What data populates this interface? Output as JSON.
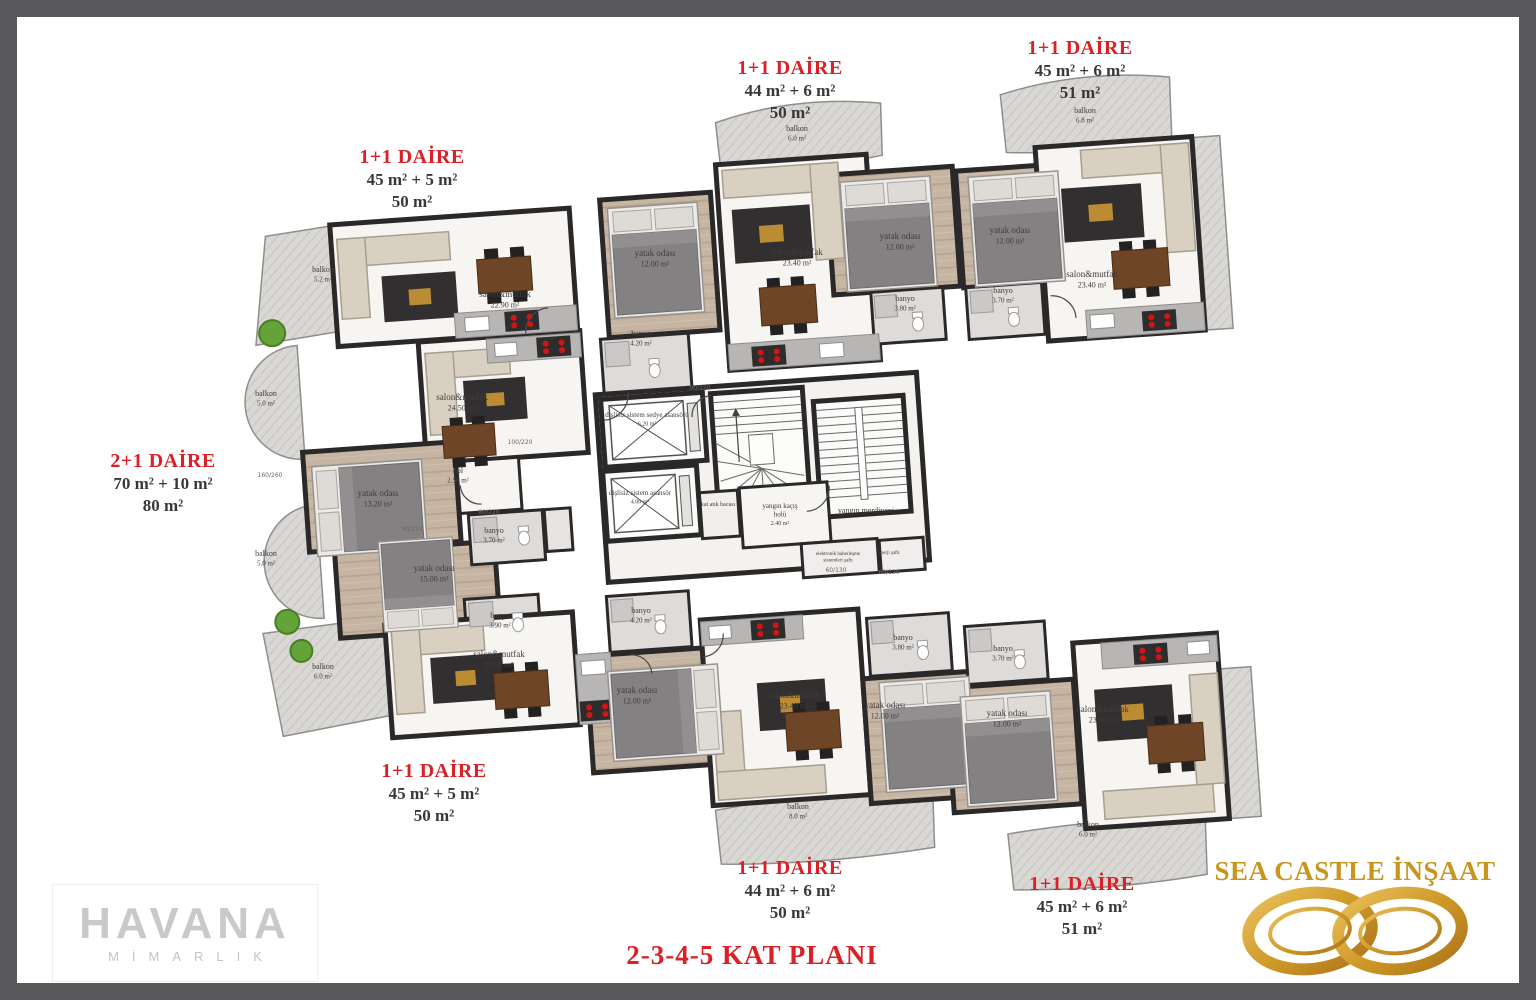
{
  "title": {
    "text": "2-3-4-5 KAT PLANI",
    "color": "#da2128"
  },
  "colors": {
    "label_red": "#da2128",
    "text_dark": "#3b3737",
    "wall": "#2b282a",
    "gold": "#c8961e",
    "logo_gray": "#c9c9c9",
    "frame_gray": "#59585b"
  },
  "apartments": [
    {
      "title": "1+1 DAİRE",
      "line1": "45 m² + 5 m²",
      "line2": "50 m²",
      "x": 412,
      "y": 146
    },
    {
      "title": "1+1 DAİRE",
      "line1": "44 m² + 6 m²",
      "line2": "50 m²",
      "x": 790,
      "y": 57
    },
    {
      "title": "1+1 DAİRE",
      "line1": "45 m² + 6 m²",
      "line2": "51 m²",
      "x": 1080,
      "y": 37
    },
    {
      "title": "2+1 DAİRE",
      "line1": "70 m² + 10 m²",
      "line2": "80 m²",
      "x": 163,
      "y": 450
    },
    {
      "title": "1+1 DAİRE",
      "line1": "45 m² + 5 m²",
      "line2": "50 m²",
      "x": 434,
      "y": 760
    },
    {
      "title": "1+1 DAİRE",
      "line1": "44 m² + 6 m²",
      "line2": "50 m²",
      "x": 790,
      "y": 857
    },
    {
      "title": "1+1 DAİRE",
      "line1": "45 m² + 6 m²",
      "line2": "51 m²",
      "x": 1082,
      "y": 873
    }
  ],
  "room_labels": [
    {
      "x": 505,
      "y": 297,
      "lines": [
        "salon&mutfak",
        "22.90 m²"
      ]
    },
    {
      "x": 323,
      "y": 272,
      "lines": [
        "balkon",
        "5.2 m²"
      ],
      "fs": 8
    },
    {
      "x": 462,
      "y": 400,
      "lines": [
        "salon&mutfak",
        "24.50 m²"
      ]
    },
    {
      "x": 266,
      "y": 396,
      "lines": [
        "balkon",
        "5.0 m²"
      ],
      "fs": 8
    },
    {
      "x": 378,
      "y": 496,
      "lines": [
        "yatak odası",
        "13.20 m²"
      ]
    },
    {
      "x": 458,
      "y": 473,
      "lines": [
        "hol",
        "2.50 m²"
      ],
      "fs": 8
    },
    {
      "x": 494,
      "y": 533,
      "lines": [
        "banyo",
        "3.70 m²"
      ],
      "fs": 8
    },
    {
      "x": 266,
      "y": 556,
      "lines": [
        "balkon",
        "5.0 m²"
      ],
      "fs": 8
    },
    {
      "x": 434,
      "y": 571,
      "lines": [
        "yatak odası",
        "15.00 m²"
      ]
    },
    {
      "x": 500,
      "y": 618,
      "lines": [
        "banyo",
        "3.90 m²"
      ],
      "fs": 8
    },
    {
      "x": 323,
      "y": 669,
      "lines": [
        "balkon",
        "6.0 m²"
      ],
      "fs": 8
    },
    {
      "x": 655,
      "y": 256,
      "lines": [
        "yatak odası",
        "12.00 m²"
      ]
    },
    {
      "x": 641,
      "y": 336,
      "lines": [
        "banyo",
        "4.20 m²"
      ],
      "fs": 8
    },
    {
      "x": 797,
      "y": 255,
      "lines": [
        "salon&mutfak",
        "23.40 m²"
      ]
    },
    {
      "x": 900,
      "y": 239,
      "lines": [
        "yatak odası",
        "12.00 m²"
      ]
    },
    {
      "x": 905,
      "y": 301,
      "lines": [
        "banyo",
        "3.80 m²"
      ],
      "fs": 8
    },
    {
      "x": 797,
      "y": 131,
      "lines": [
        "balkon",
        "6.0 m²"
      ],
      "fs": 8
    },
    {
      "x": 1010,
      "y": 233,
      "lines": [
        "yatak odası",
        "12.00 m²"
      ]
    },
    {
      "x": 1003,
      "y": 293,
      "lines": [
        "banyo",
        "3.70 m²"
      ],
      "fs": 8
    },
    {
      "x": 1092,
      "y": 277,
      "lines": [
        "salon&mutfak",
        "23.40 m²"
      ]
    },
    {
      "x": 1085,
      "y": 113,
      "lines": [
        "balkon",
        "6.8 m²"
      ],
      "fs": 8
    },
    {
      "x": 647,
      "y": 417,
      "lines": [
        "dişlisiz sistem sedye asansörü",
        "6.20 m²"
      ],
      "fs": 7
    },
    {
      "x": 640,
      "y": 495,
      "lines": [
        "dişlisiz sistem asansör",
        "4.00 m²"
      ],
      "fs": 7
    },
    {
      "x": 718,
      "y": 506,
      "lines": [
        "kat atık bacası"
      ],
      "fs": 6
    },
    {
      "x": 780,
      "y": 508,
      "lines": [
        "yangın kaçış",
        "holü",
        "2.40 m²"
      ],
      "fs": 7
    },
    {
      "x": 866,
      "y": 513,
      "lines": [
        "yangın merdiveni"
      ],
      "fs": 8
    },
    {
      "x": 838,
      "y": 555,
      "lines": [
        "elektronik haberleşme",
        "sistemleri şaftı"
      ],
      "fs": 5
    },
    {
      "x": 889,
      "y": 554,
      "lines": [
        "enerji şaftı"
      ],
      "fs": 5
    },
    {
      "x": 499,
      "y": 657,
      "lines": [
        "salon&mutfak",
        "22.90 m²"
      ]
    },
    {
      "x": 641,
      "y": 613,
      "lines": [
        "banyo",
        "4.20 m²"
      ],
      "fs": 8
    },
    {
      "x": 637,
      "y": 693,
      "lines": [
        "yatak odası",
        "12.00 m²"
      ]
    },
    {
      "x": 794,
      "y": 698,
      "lines": [
        "salon&mutfak",
        "23.40 m²"
      ]
    },
    {
      "x": 903,
      "y": 640,
      "lines": [
        "banyo",
        "3.80 m²"
      ],
      "fs": 8
    },
    {
      "x": 885,
      "y": 708,
      "lines": [
        "yatak odası",
        "12.00 m²"
      ]
    },
    {
      "x": 1003,
      "y": 651,
      "lines": [
        "banyo",
        "3.70 m²"
      ],
      "fs": 8
    },
    {
      "x": 1007,
      "y": 716,
      "lines": [
        "yatak odası",
        "12.00 m²"
      ]
    },
    {
      "x": 1103,
      "y": 712,
      "lines": [
        "salon&mutfak",
        "23.40 m²"
      ]
    },
    {
      "x": 798,
      "y": 809,
      "lines": [
        "balkon",
        "8.0 m²"
      ],
      "fs": 8
    },
    {
      "x": 1088,
      "y": 827,
      "lines": [
        "balkon",
        "6.0 m²"
      ],
      "fs": 8
    }
  ],
  "dim_labels": [
    {
      "x": 270,
      "y": 477,
      "t": "160/260"
    },
    {
      "x": 520,
      "y": 444,
      "t": "100/220"
    },
    {
      "x": 412,
      "y": 531,
      "t": "90/220"
    },
    {
      "x": 489,
      "y": 514,
      "t": "80/220"
    },
    {
      "x": 700,
      "y": 390,
      "t": "90/220"
    },
    {
      "x": 836,
      "y": 572,
      "t": "60/130"
    },
    {
      "x": 889,
      "y": 574,
      "t": "60/120"
    }
  ],
  "logos": {
    "havana": {
      "title": "HAVANA",
      "subtitle": "MİMARLIK"
    },
    "sea_castle": {
      "title": "SEA CASTLE İNŞAAT"
    }
  }
}
